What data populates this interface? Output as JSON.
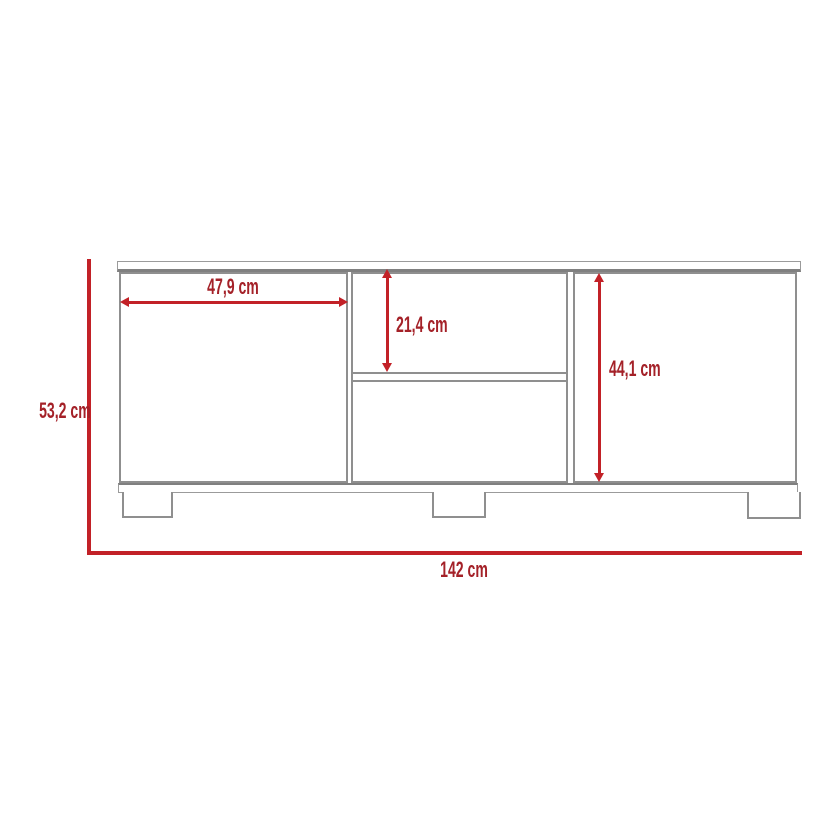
{
  "diagram": {
    "type": "furniture-dimension-diagram",
    "subject": "tv-stand-front-view",
    "unit": "cm",
    "colors": {
      "dimension_line": "#c22127",
      "dimension_text": "#a42128",
      "furniture_line": "#8f8f8f",
      "background": "#ffffff"
    },
    "measurements": [
      {
        "id": "left_door_width",
        "label": "47,9 cm",
        "orientation": "horizontal",
        "refers_to": "left-door-width"
      },
      {
        "id": "opening_height",
        "label": "21,4 cm",
        "orientation": "vertical",
        "refers_to": "center-shelf-opening-height"
      },
      {
        "id": "right_door_height",
        "label": "44,1 cm",
        "orientation": "vertical",
        "refers_to": "right-door-height"
      },
      {
        "id": "overall_height",
        "label": "53,2 cm",
        "orientation": "vertical",
        "refers_to": "overall-height"
      },
      {
        "id": "overall_width",
        "label": "142 cm",
        "orientation": "horizontal",
        "refers_to": "overall-width"
      }
    ]
  }
}
